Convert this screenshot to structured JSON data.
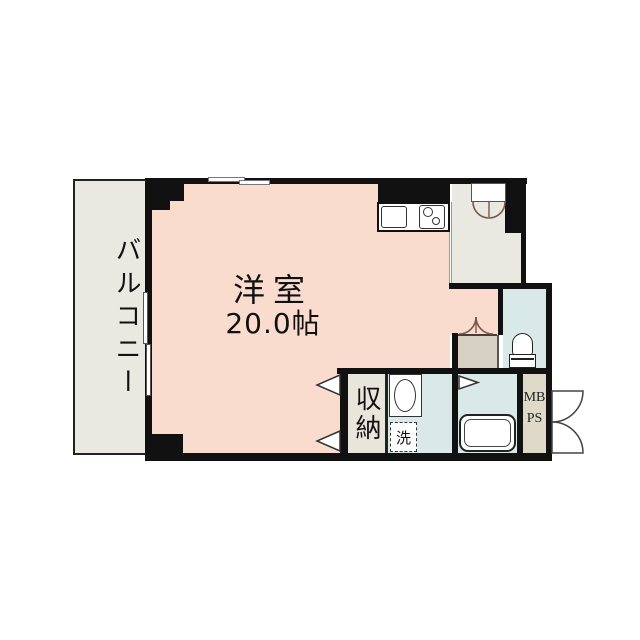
{
  "plan": {
    "type": "japanese-apartment-floor-plan",
    "balcony": {
      "label": "バルコニー"
    },
    "main_room": {
      "name": "洋室",
      "size": "20.0帖"
    },
    "storage": {
      "label": "収納"
    },
    "laundry": {
      "label": "洗"
    },
    "shaft": {
      "line1": "MB",
      "line2": "PS"
    },
    "colors": {
      "room_floor": "#fadccf",
      "balcony_floor": "#eae9e1",
      "wet_room_floor": "#d9e9e7",
      "storage_floor": "#e8e6dc",
      "small_closet_floor": "#d6d1c2",
      "shaft_floor": "#ded9c9",
      "wall": "#111111",
      "background": "#ffffff"
    }
  }
}
